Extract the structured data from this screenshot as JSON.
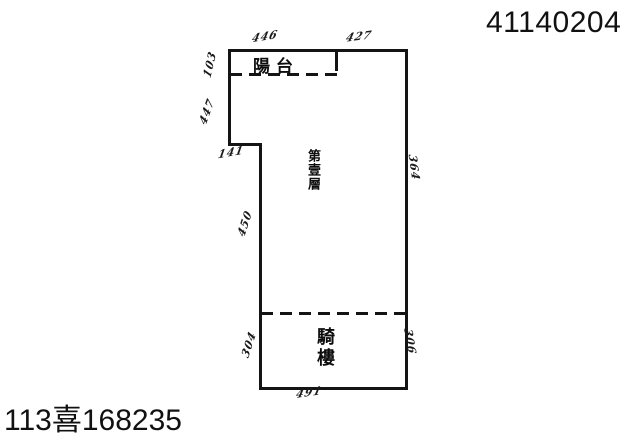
{
  "page": {
    "header_number": "41140204",
    "case_number": "113喜168235"
  },
  "floor_plan": {
    "type": "building-survey-plan",
    "rooms": {
      "balcony_label": "陽台",
      "first_floor_label": "第壹層",
      "arcade_label": "騎樓"
    },
    "dimensions": {
      "top_left": "446",
      "top_right": "427",
      "balcony_left": "103",
      "left_upper": "447",
      "step": "141",
      "right": "364",
      "left_middle": "450",
      "arcade_left": "304",
      "arcade_right": "306",
      "bottom": "491"
    },
    "colors": {
      "ink": "#141414",
      "background": "#ffffff"
    }
  }
}
